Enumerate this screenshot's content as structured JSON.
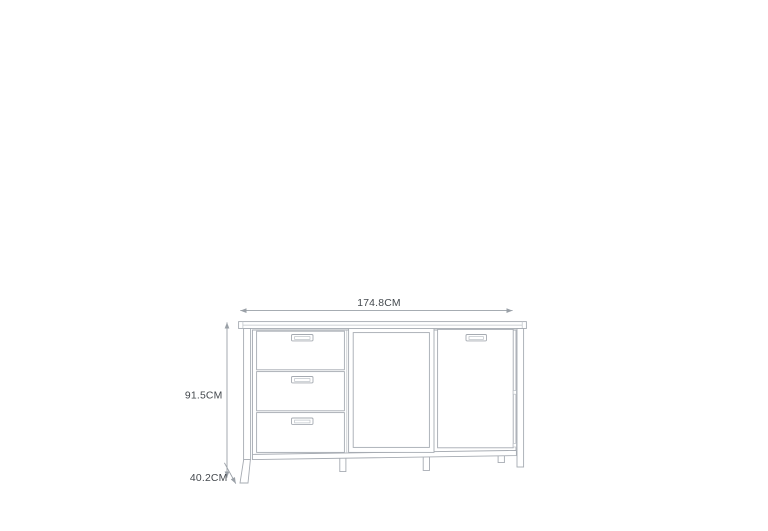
{
  "diagram": {
    "type": "furniture-dimension-drawing",
    "subject": "sideboard with three drawers, slatted sliding door and plain door",
    "colors": {
      "background": "#ffffff",
      "drawing_line": "#a6abb2",
      "light_line": "#bcc1c7",
      "dimension_line": "#9aa0a7",
      "label_text": "#43484d"
    },
    "labels": {
      "width": "174.8CM",
      "height": "91.5CM",
      "depth": "40.2CM"
    }
  }
}
